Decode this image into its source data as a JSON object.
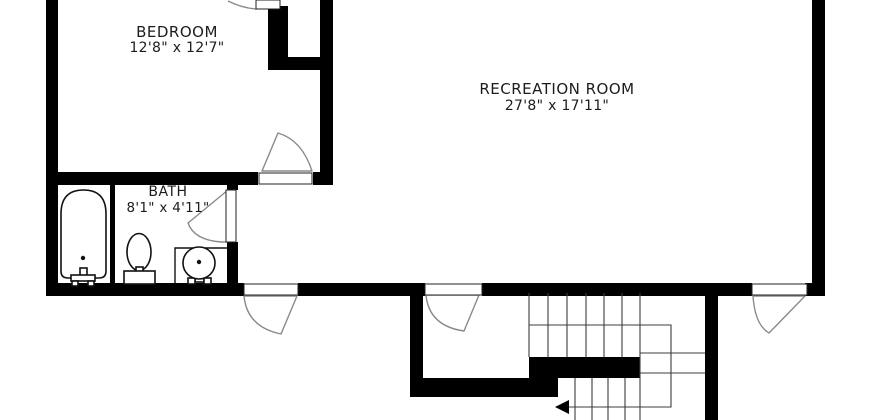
{
  "plan": {
    "title": "basement floor plan",
    "rooms": [
      {
        "id": "bedroom",
        "name": "BEDROOM",
        "dimensions": "12'8\" x 12'7\""
      },
      {
        "id": "bath",
        "name": "BATH",
        "dimensions": "8'1\" x 4'11\""
      },
      {
        "id": "recreation",
        "name": "RECREATION ROOM",
        "dimensions": "27'8\" x 17'11\""
      }
    ],
    "fixtures": [
      "bathtub-icon",
      "toilet-icon",
      "pedestal-sink-icon",
      "stairs-icon",
      "door-swing-icon",
      "stair-direction-arrow-icon"
    ],
    "stairs": {
      "direction_arrow": "left"
    },
    "colors": {
      "wall": "#000000",
      "background": "#ffffff",
      "door_swing_stroke": "#8a8a8a",
      "stair_line": "#3c3c3c",
      "text": "#1c1c1c"
    }
  }
}
